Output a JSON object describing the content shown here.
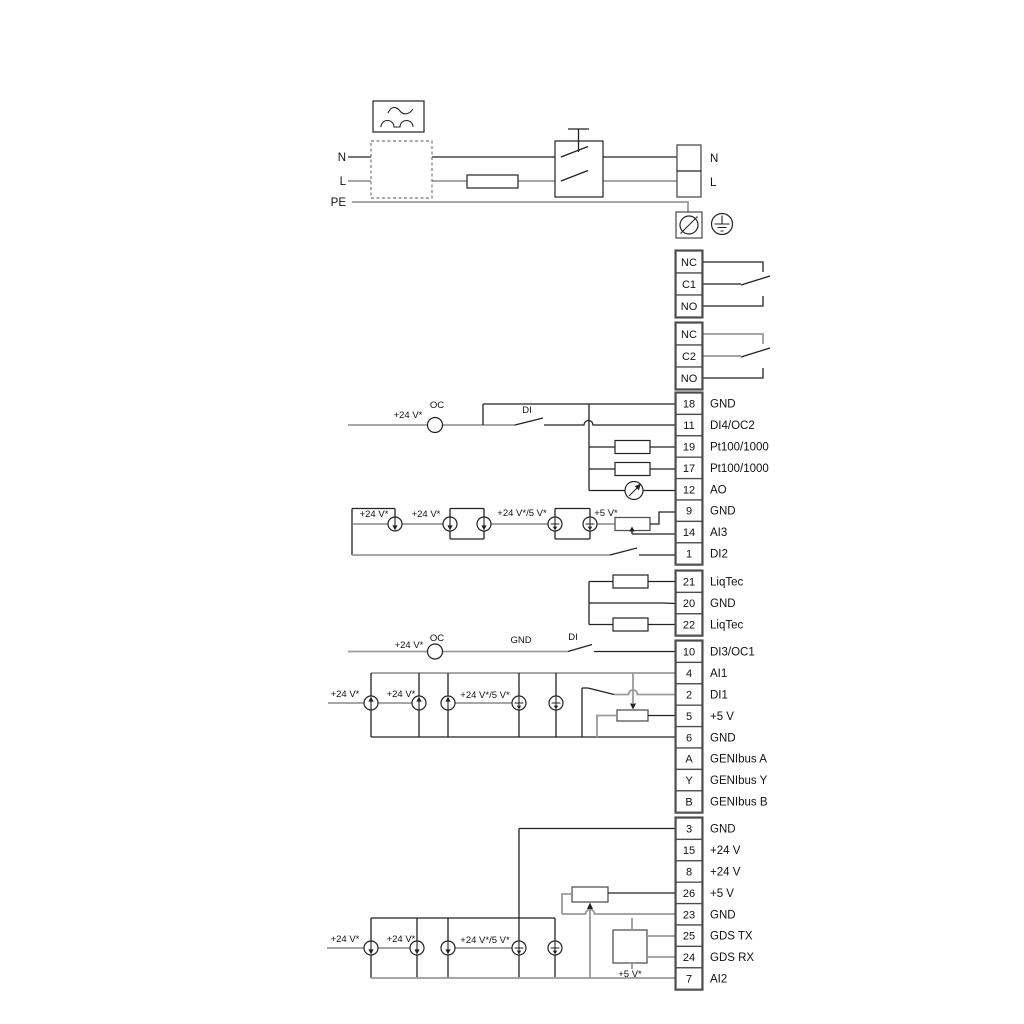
{
  "power": {
    "neutral": "N",
    "line": "L",
    "pe": "PE",
    "terminal_n": "N",
    "terminal_l": "L"
  },
  "relays": [
    {
      "cells": [
        "NC",
        "C1",
        "NO"
      ]
    },
    {
      "cells": [
        "NC",
        "C2",
        "NO"
      ]
    }
  ],
  "terminal_groups": [
    {
      "id": "a",
      "terminals": [
        {
          "num": "18",
          "label": "GND"
        },
        {
          "num": "11",
          "label": "DI4/OC2"
        },
        {
          "num": "19",
          "label": "Pt100/1000"
        },
        {
          "num": "17",
          "label": "Pt100/1000"
        },
        {
          "num": "12",
          "label": "AO"
        },
        {
          "num": "9",
          "label": "GND"
        },
        {
          "num": "14",
          "label": "AI3"
        },
        {
          "num": "1",
          "label": "DI2"
        }
      ]
    },
    {
      "id": "b",
      "terminals": [
        {
          "num": "21",
          "label": "LiqTec"
        },
        {
          "num": "20",
          "label": "GND"
        },
        {
          "num": "22",
          "label": "LiqTec"
        }
      ]
    },
    {
      "id": "c",
      "terminals": [
        {
          "num": "10",
          "label": "DI3/OC1"
        },
        {
          "num": "4",
          "label": "AI1"
        },
        {
          "num": "2",
          "label": "DI1"
        },
        {
          "num": "5",
          "label": "+5 V"
        },
        {
          "num": "6",
          "label": "GND"
        },
        {
          "num": "A",
          "label": "GENIbus A"
        },
        {
          "num": "Y",
          "label": "GENIbus Y"
        },
        {
          "num": "B",
          "label": "GENIbus B"
        }
      ]
    },
    {
      "id": "d",
      "terminals": [
        {
          "num": "3",
          "label": "GND"
        },
        {
          "num": "15",
          "label": "+24 V"
        },
        {
          "num": "8",
          "label": "+24 V"
        },
        {
          "num": "26",
          "label": "+5 V"
        },
        {
          "num": "23",
          "label": "GND"
        },
        {
          "num": "25",
          "label": "GDS TX"
        },
        {
          "num": "24",
          "label": "GDS RX"
        },
        {
          "num": "7",
          "label": "AI2"
        }
      ]
    }
  ],
  "annotations": {
    "v24": "+24 V*",
    "v24_5": "+24 V*/5 V*",
    "v5": "+5 V*",
    "oc": "OC",
    "di": "DI",
    "gnd": "GND"
  },
  "colors": {
    "wire_dark": "#222222",
    "wire_gray": "#9a9a9a",
    "wire_mid": "#555555",
    "box_border": "#4d4d4d",
    "text": "#111111"
  }
}
